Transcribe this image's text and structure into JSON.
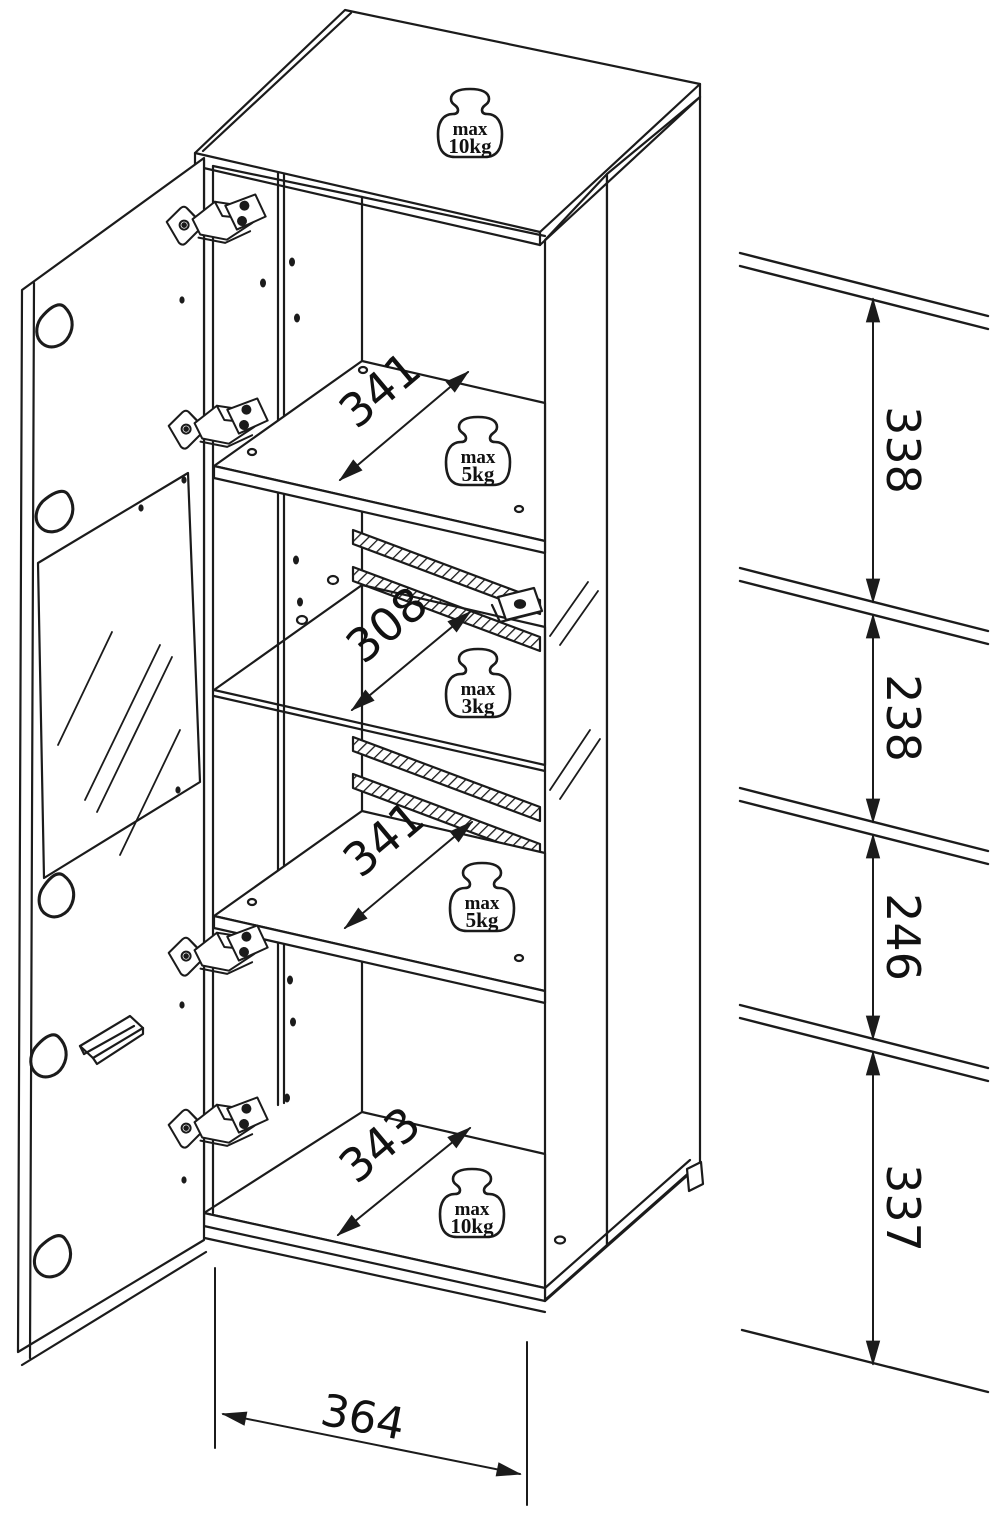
{
  "style": {
    "background": "#ffffff",
    "line_color": "#1b1b1b",
    "text_color": "#111111"
  },
  "weight_limits": [
    {
      "location": "top-panel",
      "line1": "max",
      "line2": "10kg"
    },
    {
      "location": "upper-shelf",
      "line1": "max",
      "line2": "5kg"
    },
    {
      "location": "glass-shelf",
      "line1": "max",
      "line2": "3kg"
    },
    {
      "location": "lower-shelf",
      "line1": "max",
      "line2": "5kg"
    },
    {
      "location": "bottom-panel",
      "line1": "max",
      "line2": "10kg"
    }
  ],
  "internal_widths": [
    {
      "location": "upper-shelf",
      "value": "341"
    },
    {
      "location": "glass-shelf",
      "value": "308"
    },
    {
      "location": "lower-shelf",
      "value": "341"
    },
    {
      "location": "bottom-panel",
      "value": "343"
    }
  ],
  "overall_width": {
    "value": "364"
  },
  "section_heights": [
    {
      "position": "top",
      "value": "338"
    },
    {
      "position": "upper-middle",
      "value": "238"
    },
    {
      "position": "lower-middle",
      "value": "246"
    },
    {
      "position": "bottom",
      "value": "337"
    }
  ]
}
